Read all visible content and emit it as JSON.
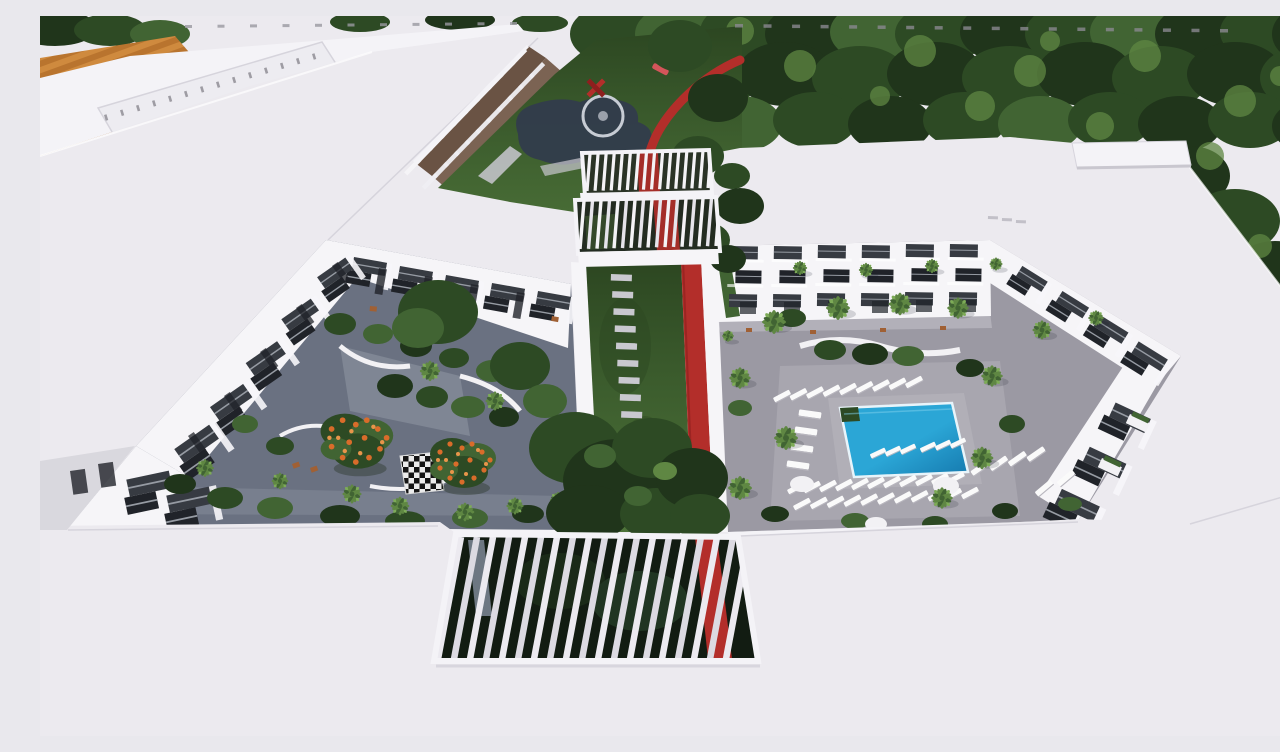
{
  "scene": {
    "title": "Aerial rendering of apartment complex",
    "description": "Aerial 3D architectural rendering of a white apartment complex with two landscaped interior courtyards, a blue swimming pool with white sun loungers, palm trees, a giant outdoor chessboard, red winding pathways, white louvered pergolas and dense green tree canopy around the buildings.",
    "colors": {
      "roof_top": "#f4f3f7",
      "roof_main": "#eceaef",
      "roof_low": "#e6e4ea",
      "roof_edge": "#d6d4dc",
      "facade_white": "#f6f5f8",
      "facade_shade": "#d9d8de",
      "tree_deep": "#20351b",
      "tree_dark": "#2d4a24",
      "tree_mid": "#416433",
      "tree_light": "#5f8743",
      "tree_pale": "#7dab57",
      "lawn": "#3a5a2c",
      "lawn_light": "#4d7339",
      "lawn_dark": "#2c4621",
      "pave_left": "#6a7181",
      "pave_left_light": "#999fab",
      "pave_right": "#9b99a3",
      "pave_right_light": "#b5b3bb",
      "walk_light": "#c9c8d0",
      "stone": "#c9c8cf",
      "pool": "#2ba6d6",
      "pool_deep": "#1579ae",
      "red": "#b32e2a",
      "red_dark": "#8e1f1e",
      "bal_dark": "#373b42",
      "bal_deep": "#202329",
      "rail": "#969ba3",
      "planter": "#f2f1f4",
      "court_orange": "#cf8a3e",
      "court_orange2": "#b9742e",
      "flower": "#d96c2a",
      "flower2": "#e8954a",
      "wood": "#a06034",
      "navy": "#323c4c",
      "ring": "#c7ccd4"
    },
    "canopy": [
      [
        575,
        18,
        45,
        30,
        "dark"
      ],
      [
        640,
        18,
        45,
        30,
        "mid"
      ],
      [
        705,
        16,
        45,
        30,
        "dark"
      ],
      [
        770,
        18,
        45,
        30,
        "deep"
      ],
      [
        835,
        16,
        45,
        30,
        "mid"
      ],
      [
        900,
        18,
        45,
        30,
        "dark"
      ],
      [
        965,
        16,
        45,
        30,
        "deep"
      ],
      [
        1030,
        18,
        45,
        30,
        "dark"
      ],
      [
        1095,
        16,
        45,
        30,
        "mid"
      ],
      [
        1160,
        18,
        45,
        30,
        "deep"
      ],
      [
        1225,
        16,
        45,
        30,
        "dark"
      ],
      [
        1272,
        18,
        40,
        30,
        "deep"
      ],
      [
        600,
        60,
        48,
        32,
        "deep"
      ],
      [
        670,
        62,
        48,
        32,
        "dark"
      ],
      [
        745,
        58,
        48,
        32,
        "deep"
      ],
      [
        820,
        62,
        48,
        32,
        "dark"
      ],
      [
        895,
        58,
        48,
        32,
        "deep"
      ],
      [
        970,
        62,
        48,
        32,
        "dark"
      ],
      [
        1045,
        58,
        48,
        32,
        "deep"
      ],
      [
        1120,
        62,
        48,
        32,
        "dark"
      ],
      [
        1195,
        58,
        48,
        32,
        "deep"
      ],
      [
        1265,
        62,
        45,
        32,
        "dark"
      ],
      [
        630,
        105,
        42,
        28,
        "dark"
      ],
      [
        700,
        108,
        42,
        28,
        "mid"
      ],
      [
        775,
        104,
        42,
        28,
        "dark"
      ],
      [
        850,
        108,
        42,
        28,
        "deep"
      ],
      [
        925,
        104,
        42,
        28,
        "dark"
      ],
      [
        1000,
        108,
        42,
        28,
        "mid"
      ],
      [
        1070,
        104,
        42,
        28,
        "dark"
      ],
      [
        1140,
        108,
        42,
        28,
        "deep"
      ],
      [
        1210,
        104,
        42,
        28,
        "dark"
      ],
      [
        1268,
        110,
        36,
        26,
        "deep"
      ],
      [
        1150,
        160,
        40,
        30,
        "deep"
      ],
      [
        1195,
        205,
        45,
        32,
        "dark"
      ],
      [
        1235,
        255,
        42,
        30,
        "deep"
      ],
      [
        1265,
        300,
        40,
        28,
        "dark"
      ],
      [
        1278,
        335,
        30,
        22,
        "mid"
      ],
      [
        15,
        12,
        42,
        18,
        "deep"
      ],
      [
        70,
        14,
        36,
        16,
        "dark"
      ],
      [
        120,
        18,
        30,
        14,
        "mid"
      ],
      [
        320,
        6,
        30,
        10,
        "dark"
      ],
      [
        420,
        4,
        35,
        10,
        "deep"
      ],
      [
        500,
        7,
        28,
        9,
        "dark"
      ]
    ],
    "canopy_highlights": [
      [
        640,
        30,
        16
      ],
      [
        760,
        50,
        16
      ],
      [
        880,
        35,
        16
      ],
      [
        990,
        55,
        16
      ],
      [
        1105,
        40,
        16
      ],
      [
        1200,
        85,
        16
      ],
      [
        700,
        15,
        14
      ],
      [
        940,
        90,
        15
      ],
      [
        1060,
        110,
        14
      ],
      [
        1170,
        140,
        14
      ],
      [
        615,
        70,
        10
      ],
      [
        840,
        80,
        10
      ],
      [
        1010,
        25,
        10
      ],
      [
        1240,
        60,
        10
      ],
      [
        1220,
        230,
        12
      ],
      [
        1255,
        290,
        10
      ]
    ],
    "front_trees": [
      [
        648,
        193,
        26,
        20,
        "deep"
      ],
      [
        668,
        224,
        22,
        17,
        "dark"
      ],
      [
        688,
        243,
        18,
        14,
        "deep"
      ],
      [
        692,
        160,
        18,
        13,
        "dark"
      ],
      [
        702,
        196,
        15,
        11,
        "deep"
      ],
      [
        640,
        30,
        32,
        26,
        "dark"
      ],
      [
        678,
        82,
        30,
        24,
        "deep"
      ],
      [
        658,
        140,
        26,
        20,
        "dark"
      ],
      [
        700,
        190,
        24,
        18,
        "deep"
      ],
      [
        398,
        296,
        40,
        32,
        "dark"
      ],
      [
        378,
        312,
        26,
        20,
        "mid"
      ],
      [
        480,
        350,
        30,
        24,
        "dark"
      ],
      [
        505,
        385,
        22,
        17,
        "mid"
      ],
      [
        535,
        432,
        46,
        36,
        "dark"
      ],
      [
        578,
        465,
        55,
        42,
        "deep"
      ],
      [
        612,
        432,
        40,
        30,
        "dark"
      ],
      [
        548,
        497,
        42,
        28,
        "deep"
      ],
      [
        616,
        498,
        36,
        26,
        "dark"
      ],
      [
        652,
        462,
        36,
        30,
        "deep"
      ],
      [
        660,
        500,
        30,
        22,
        "dark"
      ],
      [
        560,
        440,
        16,
        12,
        "mid"
      ],
      [
        598,
        480,
        14,
        10,
        "mid"
      ],
      [
        625,
        455,
        12,
        9,
        "light"
      ]
    ],
    "roof": {
      "vents_a": {
        "x0": 145,
        "y0": 9,
        "x1": 470,
        "y1": 6,
        "n": 11,
        "w": 7,
        "h": 3
      },
      "vents_b": {
        "x0": 695,
        "y0": 8,
        "x1": 1180,
        "y1": 13,
        "n": 18,
        "w": 8,
        "h": 3.5
      },
      "sky_ticks": {
        "x0": 64,
        "y0": 99,
        "x1": 272,
        "y1": 38,
        "n": 14,
        "w": 2.6,
        "h": 6,
        "rot": -17
      },
      "sky_ticks2": {
        "x0": 86,
        "y0": 122,
        "x1": 290,
        "y1": 60,
        "n": 11,
        "w": 2.4,
        "h": 5,
        "rot": -17
      },
      "marks": [
        [
          948,
          200
        ],
        [
          962,
          202
        ],
        [
          976,
          204
        ]
      ]
    },
    "garden": {
      "red_path": "M700,44 C662,60 630,92 616,120 C606,142 604,158 607,170 C611,196 622,216 641,246"
    },
    "colonnade": {
      "n1": 10,
      "n2": 11
    },
    "left_courtyard": {
      "balconies_top": [
        [
          310,
          238
        ],
        [
          356,
          247
        ],
        [
          402,
          256
        ],
        [
          448,
          264
        ],
        [
          494,
          272
        ]
      ],
      "windows_top": [
        [
          339,
          252
        ],
        [
          385,
          260
        ],
        [
          431,
          268
        ],
        [
          477,
          276
        ]
      ],
      "balconies_left": [
        [
          272,
          262,
          1.15
        ],
        [
          236,
          304,
          1.2
        ],
        [
          200,
          348,
          1.28
        ],
        [
          164,
          392,
          1.35
        ],
        [
          128,
          434,
          1.42
        ]
      ],
      "windows_left": [
        [
          292,
          250
        ],
        [
          256,
          292
        ],
        [
          220,
          336
        ],
        [
          184,
          380
        ],
        [
          148,
          420
        ]
      ],
      "balconies_front": [
        [
          80,
          462,
          1.45
        ],
        [
          120,
          478,
          1.45
        ]
      ],
      "checker_pts": "360,440 398,436 404,474 366,478",
      "flower_trees": [
        [
          318,
          424,
          1.1
        ],
        [
          424,
          446,
          1.0
        ]
      ],
      "bushes": [
        [
          140,
          468,
          16,
          10
        ],
        [
          185,
          482,
          18,
          11
        ],
        [
          235,
          492,
          18,
          11
        ],
        [
          300,
          500,
          20,
          11
        ],
        [
          365,
          505,
          20,
          10
        ],
        [
          430,
          502,
          18,
          10
        ],
        [
          488,
          498,
          16,
          9
        ],
        [
          300,
          308,
          16,
          11
        ],
        [
          338,
          318,
          15,
          10
        ],
        [
          376,
          330,
          16,
          11
        ],
        [
          414,
          342,
          15,
          10
        ],
        [
          452,
          355,
          16,
          11
        ],
        [
          355,
          370,
          18,
          12
        ],
        [
          392,
          381,
          16,
          11
        ],
        [
          428,
          391,
          17,
          11
        ],
        [
          464,
          401,
          15,
          10
        ],
        [
          240,
          430,
          14,
          9
        ],
        [
          205,
          408,
          13,
          9
        ]
      ],
      "palms": [
        [
          390,
          355,
          0.85
        ],
        [
          455,
          385,
          0.8
        ],
        [
          165,
          452,
          0.75
        ],
        [
          240,
          465,
          0.7
        ],
        [
          312,
          478,
          0.8
        ],
        [
          360,
          490,
          0.78
        ],
        [
          425,
          496,
          0.78
        ],
        [
          475,
          490,
          0.72
        ],
        [
          518,
          484,
          0.68
        ]
      ],
      "chairs": [
        [
          252,
          448,
          -20
        ],
        [
          270,
          452,
          -20
        ],
        [
          512,
          300,
          10
        ],
        [
          330,
          290,
          5
        ]
      ]
    },
    "stones": {
      "x0": 571,
      "y0": 258,
      "x1": 589,
      "y1": 498,
      "n": 15,
      "w": 21,
      "h": 6.5
    },
    "right_courtyard": {
      "balcony_columns": [
        [
          688,
          228
        ],
        [
          732,
          228
        ],
        [
          776,
          227
        ],
        [
          820,
          227
        ],
        [
          864,
          226
        ],
        [
          908,
          226
        ]
      ],
      "ground_windows": [
        [
          700,
          286
        ],
        [
          744,
          286
        ],
        [
          788,
          285
        ],
        [
          832,
          285
        ],
        [
          876,
          284
        ],
        [
          920,
          284
        ]
      ],
      "chairs": [
        [
          706,
          312,
          0
        ],
        [
          770,
          314,
          0
        ],
        [
          840,
          312,
          0
        ],
        [
          900,
          310,
          0
        ]
      ],
      "balconies_diag": [
        [
          980,
          246,
          1.0,
          32
        ],
        [
          1020,
          271,
          1.05,
          32
        ],
        [
          1058,
          295,
          1.1,
          32
        ],
        [
          1096,
          321,
          1.15,
          32
        ]
      ],
      "balconies_inner": [
        [
          1072,
          382,
          1.3,
          25
        ],
        [
          1046,
          426,
          1.35,
          25
        ],
        [
          1018,
          468,
          1.4,
          25
        ]
      ],
      "planters_inner": [
        [
          1090,
          398
        ],
        [
          1062,
          442
        ]
      ],
      "palms": [
        [
          734,
          306,
          1.0
        ],
        [
          798,
          292,
          1.0
        ],
        [
          860,
          288,
          0.95
        ],
        [
          918,
          292,
          0.9
        ],
        [
          700,
          362,
          0.9
        ],
        [
          746,
          422,
          1.0
        ],
        [
          700,
          472,
          1.0
        ],
        [
          952,
          360,
          0.9
        ],
        [
          1002,
          314,
          0.8
        ],
        [
          942,
          442,
          0.95
        ],
        [
          902,
          482,
          0.9
        ],
        [
          1056,
          302,
          0.65
        ],
        [
          760,
          252,
          0.6
        ],
        [
          826,
          254,
          0.6
        ],
        [
          892,
          250,
          0.6
        ],
        [
          956,
          248,
          0.55
        ],
        [
          688,
          320,
          0.5
        ]
      ],
      "shrubs": [
        [
          790,
          334,
          16,
          10
        ],
        [
          830,
          338,
          18,
          11
        ],
        [
          868,
          340,
          16,
          10
        ],
        [
          752,
          302,
          14,
          9
        ],
        [
          930,
          352,
          14,
          9
        ],
        [
          700,
          392,
          12,
          8
        ],
        [
          972,
          408,
          13,
          9
        ],
        [
          735,
          498,
          14,
          8
        ],
        [
          815,
          505,
          14,
          8
        ],
        [
          895,
          508,
          13,
          8
        ],
        [
          965,
          495,
          13,
          8
        ],
        [
          1030,
          488,
          12,
          7
        ]
      ],
      "round_planters": [
        [
          762,
          468,
          12,
          8
        ],
        [
          906,
          470,
          13,
          9
        ],
        [
          836,
          508,
          11,
          7
        ]
      ],
      "loungers_rows": [
        {
          "x0": 742,
          "y0": 380,
          "x1": 874,
          "y1": 366,
          "n": 9,
          "rot": -28,
          "s": 1
        },
        {
          "x0": 770,
          "y0": 398,
          "x1": 758,
          "y1": 449,
          "n": 4,
          "rot": 8,
          "s": 1.25
        },
        {
          "x0": 756,
          "y0": 472,
          "x1": 916,
          "y1": 462,
          "n": 11,
          "rot": -28,
          "s": 1
        },
        {
          "x0": 762,
          "y0": 488,
          "x1": 930,
          "y1": 477,
          "n": 11,
          "rot": -28,
          "s": 1
        },
        {
          "x0": 940,
          "y0": 452,
          "x1": 996,
          "y1": 438,
          "n": 4,
          "rot": -35,
          "s": 1.1
        },
        {
          "x0": 1004,
          "y0": 472,
          "x1": 1026,
          "y1": 462,
          "n": 2,
          "rot": -40,
          "s": 1.1
        }
      ],
      "pool_loungers": [
        [
          838,
          437
        ],
        [
          853,
          435
        ],
        [
          868,
          433
        ],
        [
          888,
          431
        ],
        [
          903,
          429
        ],
        [
          918,
          427
        ]
      ]
    },
    "pergolas": {
      "top1": {
        "x0": 547,
        "y0": 175,
        "x1": 668,
        "y1": 172,
        "n": 16,
        "dx": 3,
        "dy": -37,
        "w": 3.2
      },
      "top2": {
        "x0": 540,
        "y0": 233,
        "x1": 676,
        "y1": 230,
        "n": 17,
        "dx": 4,
        "dy": -48,
        "w": 3.4
      },
      "bottom": {
        "x0": 398,
        "y0": 643,
        "x1": 686,
        "y1": 643,
        "n": 19,
        "dx": 23,
        "dy": -122,
        "w": 6.5
      }
    },
    "fragment_windows_upper": [
      [
        12,
        215
      ],
      [
        42,
        206
      ],
      [
        15,
        252
      ],
      [
        45,
        242
      ]
    ],
    "fragment_windows_lower": [
      [
        30,
        455
      ],
      [
        58,
        448
      ]
    ]
  }
}
